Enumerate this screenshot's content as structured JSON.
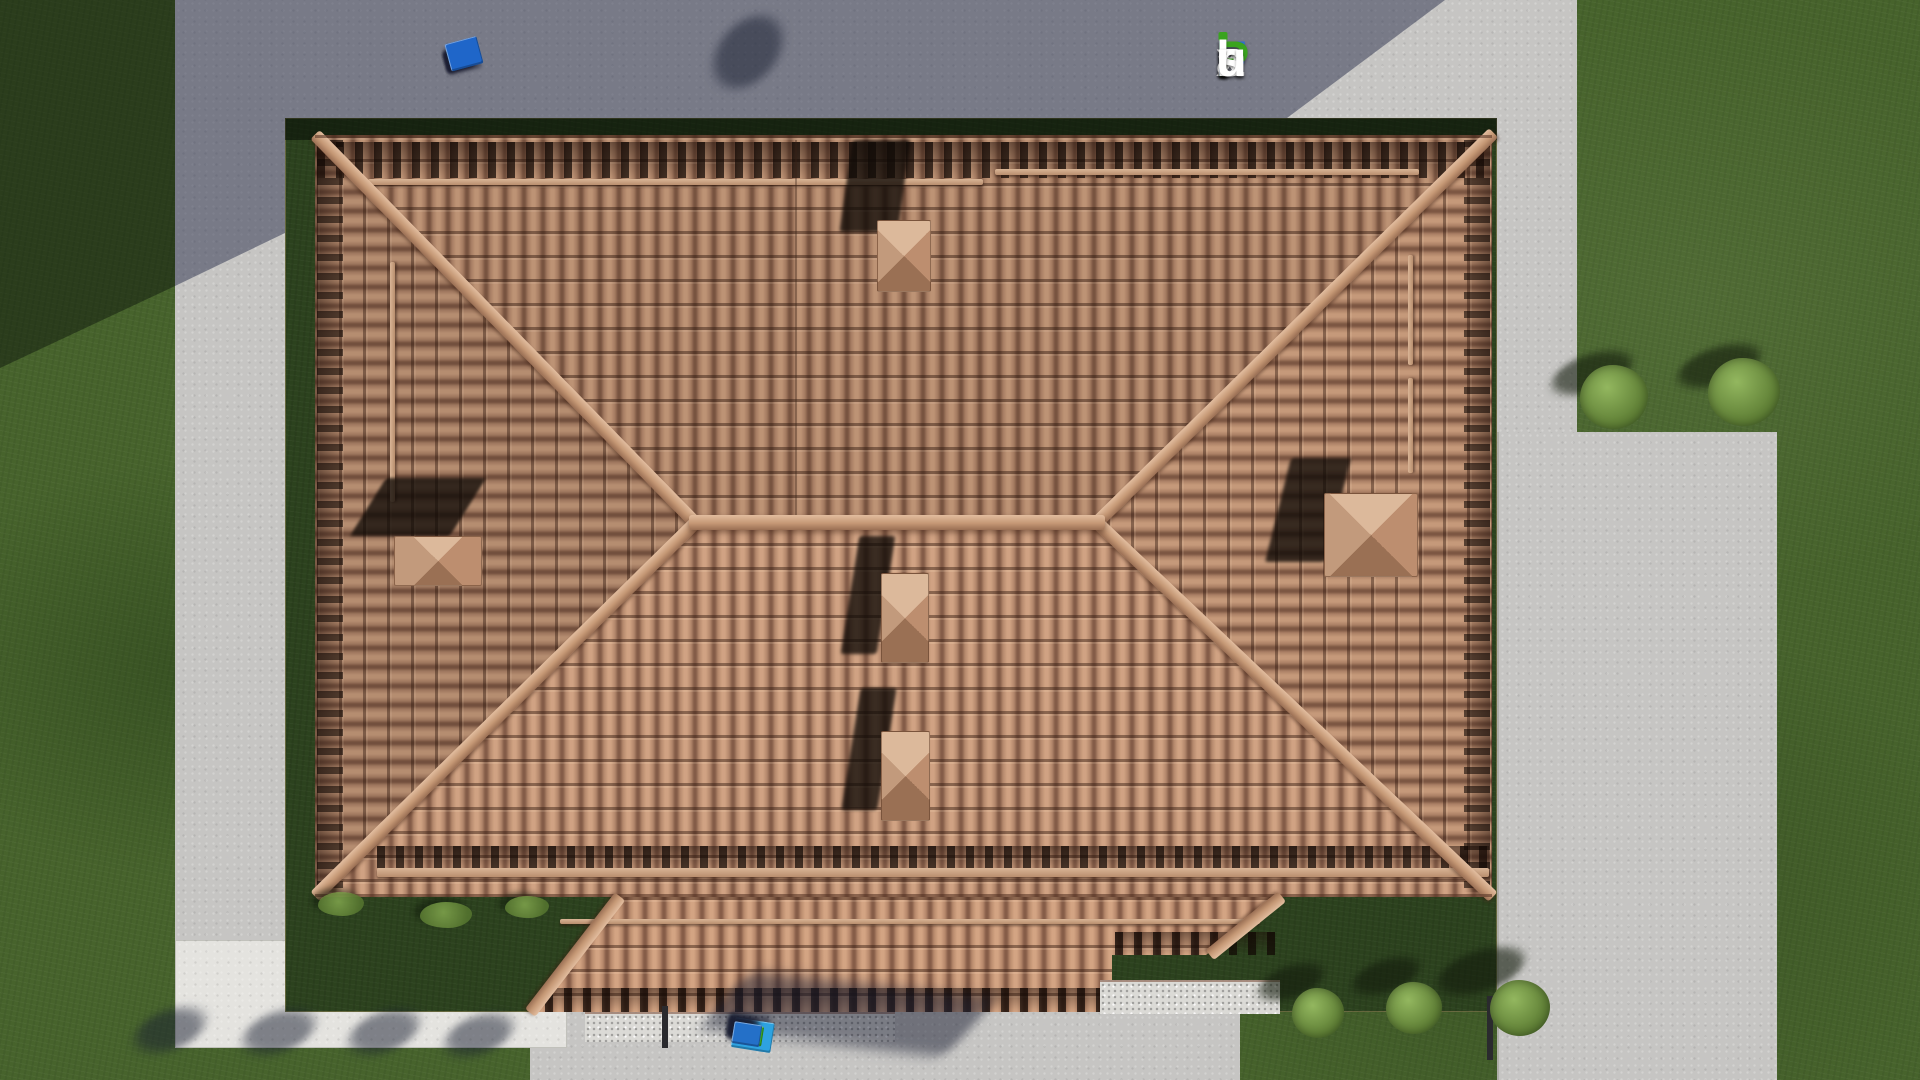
{
  "watermark": {
    "text": "FixPlans.ru",
    "letters": [
      {
        "ch": "F",
        "color": "#2e6fd2"
      },
      {
        "ch": "i",
        "stem": "ı",
        "color": "#ffffff",
        "dot": "#3aa31f"
      },
      {
        "ch": "x",
        "color": "#ffffff"
      },
      {
        "ch": "P",
        "color": "#3aa31f"
      },
      {
        "ch": "l",
        "color": "#ffffff"
      },
      {
        "ch": "a",
        "color": "#ffffff"
      },
      {
        "ch": "n",
        "color": "#ffffff"
      },
      {
        "ch": "s",
        "color": "#ffffff"
      },
      {
        "ch": ".",
        "color": "#2e6fd2"
      },
      {
        "ch": "r",
        "color": "#ffffff"
      },
      {
        "ch": "u",
        "color": "#ffffff"
      }
    ]
  },
  "scene": {
    "type": "3d-architectural-render-top-view",
    "subject": "hipped terracotta tile roof of a house with surrounding lawn and concrete paths",
    "chimney_count": 5,
    "flower_bed_count": 5,
    "round_bush_count": 5
  },
  "markers": {
    "top": {
      "blocks": [
        {
          "c": "#ececea",
          "w": 27,
          "h": 20
        },
        {
          "c": "#ececea",
          "w": 25,
          "h": 20
        },
        {
          "c": "#1f66c9",
          "w": 14,
          "h": 18
        },
        {
          "c": "#ececea",
          "w": 25,
          "h": 20
        },
        {
          "c": "#ececea",
          "w": 25,
          "h": 20
        },
        {
          "c": "#ececea",
          "w": 27,
          "h": 20
        },
        {
          "c": "#ececea",
          "w": 12,
          "h": 17
        },
        {
          "c": "#3aa520",
          "w": 29,
          "h": 21
        },
        {
          "c": "#ececea",
          "w": 25,
          "h": 20
        },
        {
          "c": "#3aa520",
          "w": 11,
          "h": 16
        },
        {
          "c": "#1f66c9",
          "w": 33,
          "h": 28
        }
      ]
    },
    "bottom": {
      "blocks": [
        {
          "c": "#2ea2e0",
          "w": 40,
          "h": 30
        },
        {
          "c": "#3aa520",
          "w": 14,
          "h": 17
        },
        {
          "c": "#f0f0ec",
          "w": 24,
          "h": 19
        },
        {
          "c": "#f0f0ec",
          "w": 22,
          "h": 19
        },
        {
          "c": "#3aa520",
          "w": 30,
          "h": 20
        },
        {
          "c": "#f0f0ec",
          "w": 22,
          "h": 19
        },
        {
          "c": "#f0f0ec",
          "w": 24,
          "h": 19
        },
        {
          "c": "#2470c8",
          "w": 28,
          "h": 22
        }
      ]
    }
  },
  "palette": {
    "grass": "#47632c",
    "lawn_plot": "#2c421e",
    "pavement": "#c6c5c3",
    "pavement_bright_path": "#e4e3df",
    "pavement_in_shadow": "#6f7487",
    "tile_base": "#b2866c",
    "tile_gap": "#7d5743",
    "ridge_cap": "#c59875",
    "chimney_cap": "#c29a7c",
    "shadow_cast": "#30364e"
  }
}
